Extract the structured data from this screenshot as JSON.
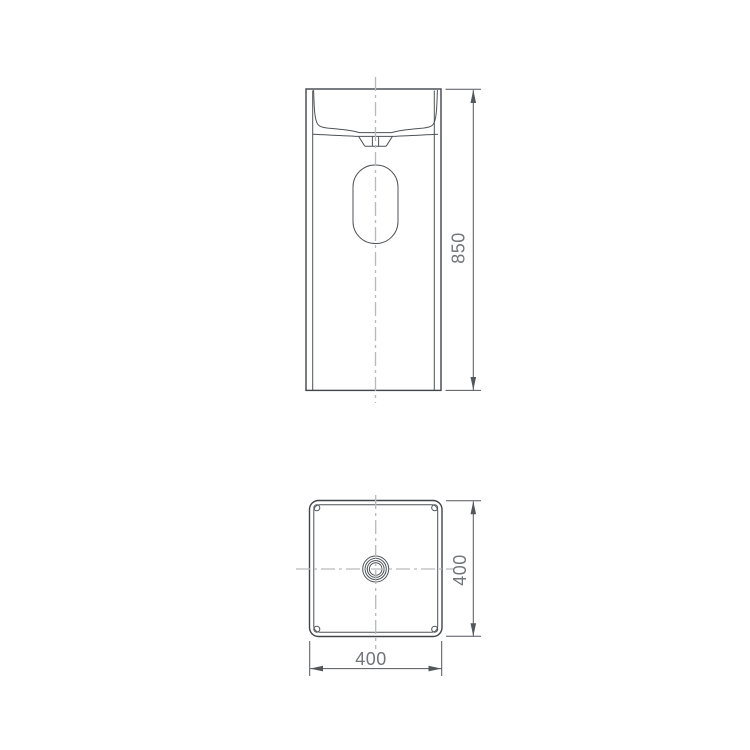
{
  "figure": {
    "front_view": {
      "height_label": "850"
    },
    "plan_view": {
      "depth_label": "400",
      "width_label": "400"
    }
  },
  "colors": {
    "background": "#ffffff",
    "outline": "#40454a",
    "detail": "#4d5257",
    "dimension": "#53575a",
    "text": "#717579",
    "centerline": "#b6babc"
  }
}
